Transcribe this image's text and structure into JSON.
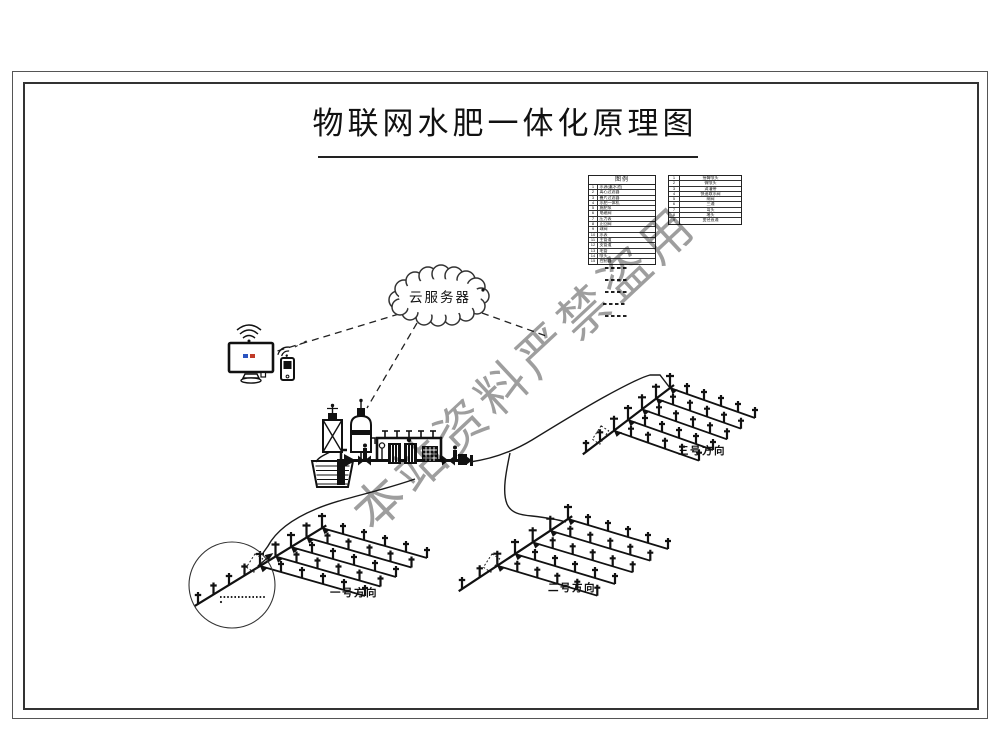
{
  "title": "物联网水肥一体化原理图",
  "cloud": {
    "label": "云服务器"
  },
  "watermark": {
    "text": "本站资料严禁盗用",
    "color": "#8d8d8d"
  },
  "legend": {
    "header": "图例",
    "left_rows": [
      {
        "no": "1",
        "label": "水源(蓄水池)"
      },
      {
        "no": "2",
        "label": "离心过滤器"
      },
      {
        "no": "3",
        "label": "叠片过滤器"
      },
      {
        "no": "4",
        "label": "水肥一体机"
      },
      {
        "no": "5",
        "label": "施肥泵"
      },
      {
        "no": "6",
        "label": "电磁阀"
      },
      {
        "no": "7",
        "label": "压力表"
      },
      {
        "no": "8",
        "label": "止回阀"
      },
      {
        "no": "9",
        "label": "球阀"
      },
      {
        "no": "10",
        "label": "水表"
      },
      {
        "no": "11",
        "label": "主管道"
      },
      {
        "no": "12",
        "label": "支管道"
      },
      {
        "no": "13",
        "label": "毛管"
      },
      {
        "no": "14",
        "label": "喷头"
      },
      {
        "no": "15",
        "label": "控制器"
      }
    ],
    "right_rows": [
      {
        "no": "1",
        "label": "摇臂喷头"
      },
      {
        "no": "2",
        "label": "微喷头"
      },
      {
        "no": "3",
        "label": "滴灌带"
      },
      {
        "no": "4",
        "label": "快速取水阀"
      },
      {
        "no": "5",
        "label": "闸阀"
      },
      {
        "no": "6",
        "label": "三通"
      },
      {
        "no": "7",
        "label": "弯头"
      },
      {
        "no": "8",
        "label": "堵头"
      },
      {
        "no": "9",
        "label": "变径直通"
      }
    ]
  },
  "fields": [
    {
      "id": "1",
      "label": "一号方向"
    },
    {
      "id": "2",
      "label": "二号方向"
    },
    {
      "id": "3",
      "label": "三号方向"
    }
  ]
}
